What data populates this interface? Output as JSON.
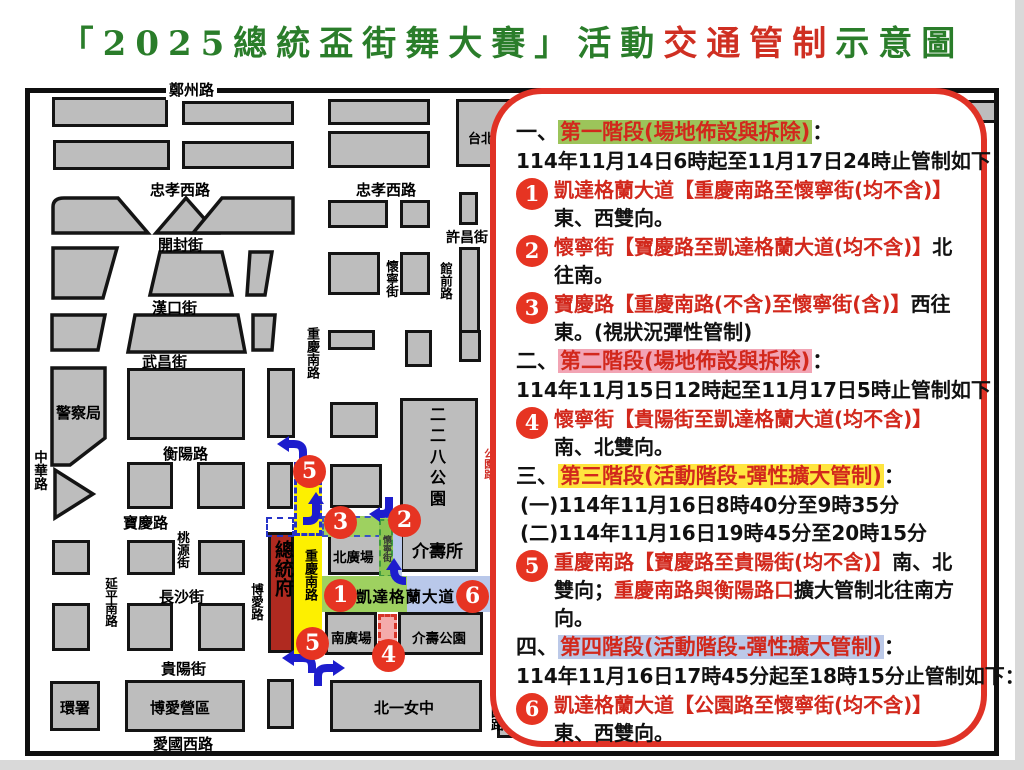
{
  "title": {
    "green1": "「2025總統盃街舞大賽」活動",
    "red": "交通管制",
    "green2": "示意圖"
  },
  "map": {
    "streets": {
      "zhengzhou": "鄭州路",
      "zhongxiao_w": "忠孝西路",
      "kaifeng": "開封街",
      "hankou": "漢口街",
      "wuchang": "武昌街",
      "hengyang": "衡陽路",
      "baoqing": "寶慶路",
      "changsha": "長沙街",
      "guiyang": "貴陽街",
      "aiguo_w": "愛國西路",
      "xuchang": "許昌街",
      "zhonghua": "中華路",
      "yanping_s": "延平南路",
      "taoyuan": "桃源街",
      "boai": "博愛路",
      "chongqing_s": "重慶南路",
      "huaining": "懷寧街",
      "guanqian": "館前路",
      "gongyuan": "公園路",
      "kaidagelan": "凱達格蘭大道"
    },
    "places": {
      "police": "警察局",
      "presidential": "總統府",
      "north_plaza": "北廣場",
      "south_plaza": "南廣場",
      "jieshou_park": "介壽公園",
      "jieshou_suo": "介壽所",
      "park228": "二二八公園",
      "beiyi": "北一女中",
      "boai_camp": "博愛營區",
      "huanshu": "環署",
      "taipei": "台北"
    },
    "badges": {
      "n1": "1",
      "n2": "2",
      "n3": "3",
      "n4": "4",
      "n5": "5",
      "n6": "6"
    },
    "icons": {
      "turn_arrow": "blue-turn-arrow"
    }
  },
  "panel": {
    "sections": [
      {
        "prefix": "一、",
        "title": "第一階段(場地佈設與拆除)",
        "colon": "：",
        "dates": [
          "114年11月14日6時起至11月17日24時止管制如下："
        ]
      },
      {
        "prefix": "二、",
        "title": "第二階段(場地佈設與拆除)",
        "colon": "：",
        "dates": [
          "114年11月15日12時起至11月17日5時止管制如下："
        ]
      },
      {
        "prefix": "三、",
        "title": "第三階段(活動階段-彈性擴大管制)",
        "colon": "：",
        "dates": [
          "(一)114年11月16日8時40分至9時35分",
          "(二)114年11月16日19時45分至20時15分"
        ]
      },
      {
        "prefix": "四、",
        "title": "第四階段(活動階段-彈性擴大管制)",
        "colon": "：",
        "dates": [
          "114年11月16日17時45分起至18時15分止管制如下："
        ]
      }
    ],
    "items": [
      {
        "num": "1",
        "r1": "凱達格蘭大道【重慶南路至懷寧街(均不含)】",
        "b1": "東、西雙向。"
      },
      {
        "num": "2",
        "r1": "懷寧街【寶慶路至凱達格蘭大道(均不含)】",
        "b1": "北往南。"
      },
      {
        "num": "3",
        "r1": "寶慶路【重慶南路(不含)至懷寧街(含)】",
        "b1": "西往東。(視狀況彈性管制)"
      },
      {
        "num": "4",
        "r1": "懷寧街【貴陽街至凱達格蘭大道(均不含)】",
        "b1": "南、北雙向。"
      },
      {
        "num": "5",
        "r1": "重慶南路【寶慶路至貴陽街(均不含)】",
        "b1": "南、北雙向；",
        "r2": "重慶南路與衡陽路口",
        "b2": "擴大管制北往南方向。"
      },
      {
        "num": "6",
        "r1": "凱達格蘭大道【公園路至懷寧街(均不含)】",
        "b1": "東、西雙向。"
      }
    ]
  },
  "colors": {
    "title_green": "#2a7d2a",
    "title_red": "#cf2f22",
    "stage1_highlight": "#9cc45a",
    "stage2_highlight": "#f2a4b4",
    "stage3_highlight": "#ffe53e",
    "stage4_highlight": "#bcc9e8",
    "badge_red": "#e63422",
    "red_text": "#d2281c",
    "zone_yellow": "#fdf000",
    "zone_green": "#9ed160",
    "zone_blue": "#b9c8ea",
    "zone_pink": "#f4abab",
    "presidential_building": "#b02a20",
    "block_gray": "#bdbdbd",
    "turn_arrow_blue": "#1d1dcd",
    "panel_border": "#e03226"
  }
}
